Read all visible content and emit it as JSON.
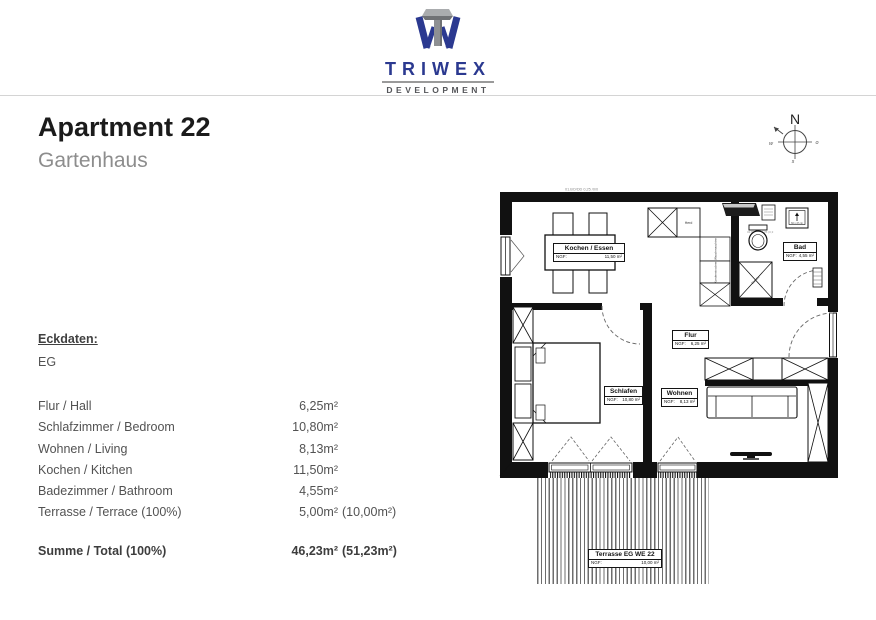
{
  "logo": {
    "brand": "TRIWEX",
    "tagline": "DEVELOPMENT"
  },
  "colors": {
    "brand_blue": "#2b3990",
    "brand_gray": "#55565a",
    "wall_black": "#111111"
  },
  "header": {
    "title": "Apartment 22",
    "subtitle": "Gartenhaus"
  },
  "compass": {
    "north": "N",
    "west": "w",
    "east": "o",
    "south": "s"
  },
  "eckdaten": {
    "heading": "Eckdaten:",
    "floor": "EG",
    "rows": [
      {
        "label": "Flur / Hall",
        "value": "6,25m²",
        "extra": ""
      },
      {
        "label": "Schlafzimmer  / Bedroom",
        "value": "10,80m²",
        "extra": ""
      },
      {
        "label": "Wohnen / Living",
        "value": "8,13m²",
        "extra": ""
      },
      {
        "label": "Kochen / Kitchen",
        "value": "11,50m²",
        "extra": ""
      },
      {
        "label": "Badezimmer / Bathroom",
        "value": "4,55m²",
        "extra": ""
      },
      {
        "label": "Terrasse / Terrace (100%)",
        "value": "5,00m²",
        "extra": "(10,00m²)"
      }
    ],
    "total": {
      "label": "Summe / Total (100%)",
      "value": "46,23m²",
      "extra": "(51,23m²)"
    }
  },
  "plan": {
    "notes": {
      "top": "01.BO/DD 0,25 /0/0",
      "bad": "02.BO/DD 0,25 (0,3"
    },
    "labels": {
      "kochen": {
        "name": "Kochen / Essen",
        "ngf_label": "NGF:",
        "area": "11,50 m²"
      },
      "bad": {
        "name": "Bad",
        "ngf_label": "NGF:",
        "area": "4,55 m²"
      },
      "flur": {
        "name": "Flur",
        "ngf_label": "NGF:",
        "area": "6,25 m²"
      },
      "schlafen": {
        "name": "Schlafen",
        "ngf_label": "NGF:",
        "area": "10,80 m²"
      },
      "wohnen": {
        "name": "Wohnen",
        "ngf_label": "NGF:",
        "area": "8,13 m²"
      },
      "terrasse": {
        "name": "Terrasse EG WE 22",
        "ngf_label": "NGF:",
        "area": "10,00 m²"
      }
    },
    "annotations": {
      "herd": "Herd",
      "waschmaschine": "Waschmaschine",
      "trockner": "Kondenstrockner",
      "dusche": "Dusche",
      "basin": "60 x 47 cm"
    }
  }
}
